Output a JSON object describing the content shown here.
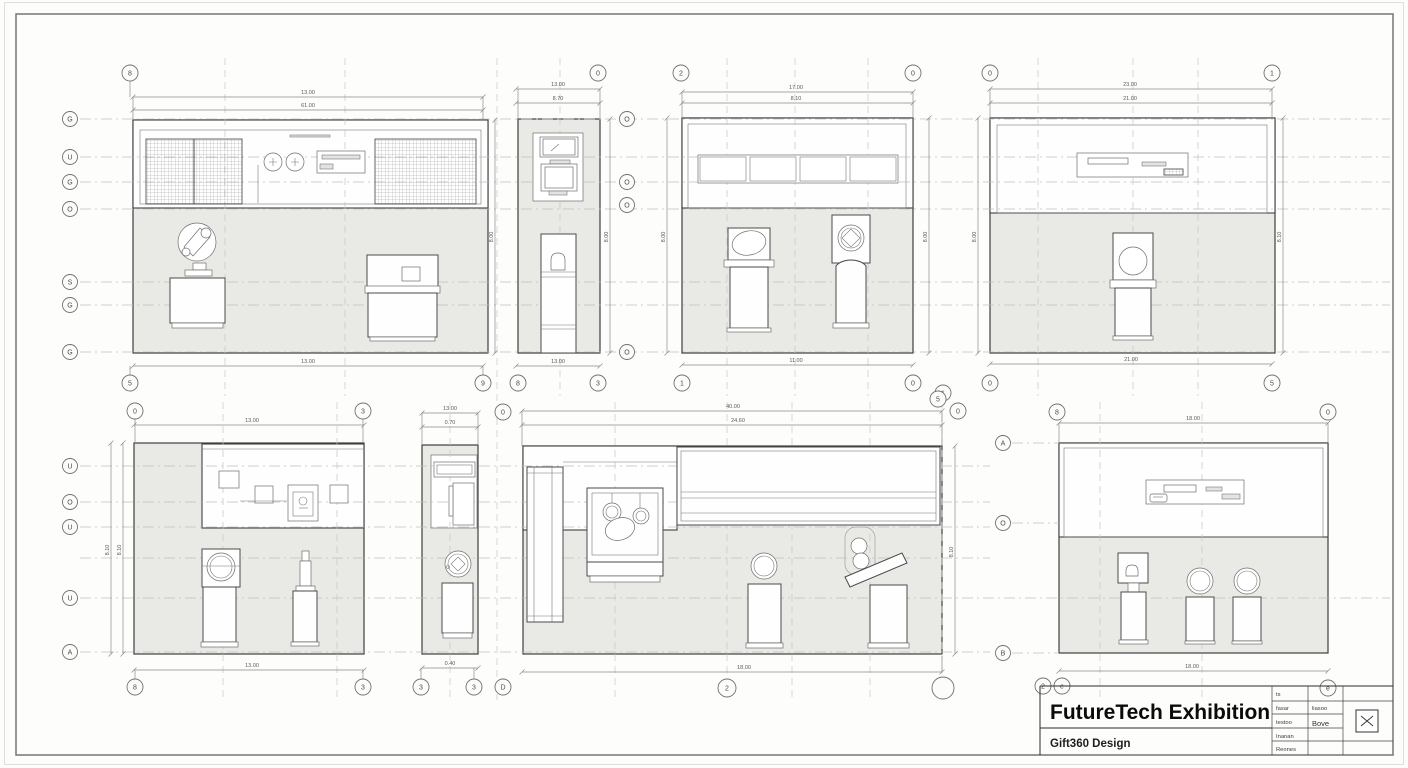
{
  "sheet": {
    "paper_color": "#fdfdfc",
    "panel_fill": "#e9e9e5",
    "line_color": "#4a4a4a",
    "dash_color": "#c6c6c6"
  },
  "title_block": {
    "title": "FutureTech Exhibition",
    "subtitle": "Gift360 Design",
    "table": {
      "r1c1": "ts",
      "r2c1": "fasar",
      "r2c2": "liasoo",
      "r3c1": "testoo",
      "r3c2": "Bove",
      "r4c1": "Inanan",
      "r5c1": "Reones"
    },
    "stamp_icon": "bowtie-mark"
  },
  "views": {
    "v1": {
      "name": "elevation-mesh-panels-robot-arm",
      "dims": {
        "top_a": "13.00",
        "top_b": "61.00",
        "bottom": "13.00",
        "right_v": "8.00"
      },
      "bubbles": {
        "tl": "8",
        "bl": "5",
        "br": "9",
        "l1": "G",
        "l2": "U",
        "l3": "G",
        "l4": "O",
        "l5": "S",
        "l6": "G",
        "l7": "G"
      }
    },
    "v2": {
      "name": "narrow-elevation-kiosk",
      "dims": {
        "top_a": "13.00",
        "top_b": "8.70",
        "bottom": "13.00",
        "right_v": "8.00"
      },
      "bubbles": {
        "tr": "0",
        "bl": "8",
        "br": "3"
      }
    },
    "v3": {
      "name": "elevation-four-panels-two-pedestals",
      "dims": {
        "top_a": "17.00",
        "top_b": "8.10",
        "bottom": "11.00",
        "left_v": "8.00",
        "right_v": "8.00"
      },
      "bubbles": {
        "tl": "2",
        "tr": "0",
        "bl": "1",
        "br": "0",
        "br2": "1",
        "g1": "O",
        "g2": "O",
        "g3": "O",
        "g4": "O"
      }
    },
    "v4": {
      "name": "elevation-sign-single-pedestal",
      "dims": {
        "top_a": "23.00",
        "top_b": "21.00",
        "bottom": "21.00",
        "left_v": "8.00",
        "right_v": "8.10"
      },
      "bubbles": {
        "tl": "0",
        "tr": "1",
        "bl": "0",
        "br": "5"
      }
    },
    "v5": {
      "name": "elevation-gallery-wall-two-pedestals",
      "dims": {
        "top": "13.00",
        "bottom": "13.00",
        "left_v1": "8.10",
        "left_v2": "8.10"
      },
      "bubbles": {
        "tl": "0",
        "tr": "3",
        "bl": "8",
        "br": "3",
        "l1": "U",
        "l2": "O",
        "l3": "U",
        "l4": "U",
        "l5": "A"
      }
    },
    "v6": {
      "name": "narrow-elevation-column",
      "dims": {
        "top_a": "13.00",
        "top_b": "0.70",
        "bottom": "0.40"
      },
      "bubbles": {
        "t": "0",
        "b1": "3",
        "b2": "3",
        "b3": "D"
      }
    },
    "v7": {
      "name": "wide-elevation-banner-display-case",
      "dims": {
        "top_a": "40.00",
        "top_b": "24.60",
        "bottom": "18.00",
        "right_v": "8.10"
      },
      "bubbles": {
        "t1": "5",
        "t2": "0",
        "b1": "2",
        "b2": ""
      }
    },
    "v8": {
      "name": "elevation-three-pedestals",
      "dims": {
        "top": "18.00",
        "bottom": "18.00"
      },
      "bubbles": {
        "tl": "8",
        "tr": "0",
        "br": "e",
        "n1": "2",
        "n2": "e",
        "l1": "A",
        "l2": "O",
        "l3": "B"
      }
    }
  }
}
